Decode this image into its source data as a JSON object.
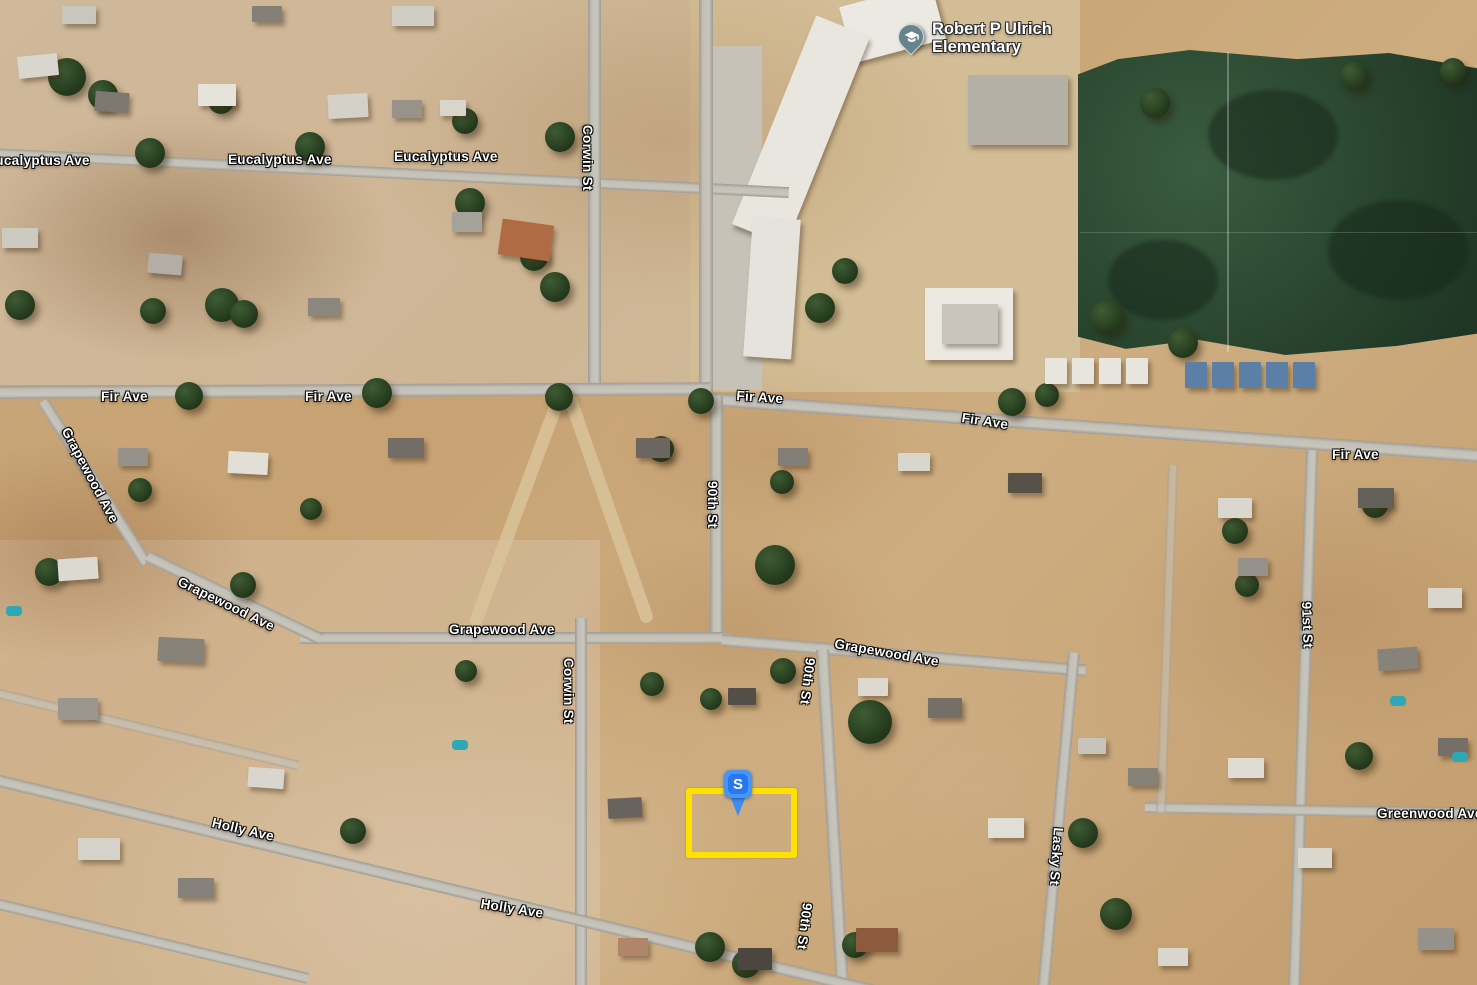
{
  "map": {
    "poi_school": {
      "line1": "Robert P Ulrich",
      "line2": "Elementary"
    },
    "marker": {
      "letter": "S"
    },
    "street_labels": [
      {
        "text": "Eucalyptus Ave"
      },
      {
        "text": "Eucalyptus Ave"
      },
      {
        "text": "Eucalyptus Ave"
      },
      {
        "text": "Corwin St"
      },
      {
        "text": "Fir Ave"
      },
      {
        "text": "Fir Ave"
      },
      {
        "text": "Fir Ave"
      },
      {
        "text": "Fir Ave"
      },
      {
        "text": "Fir Ave"
      },
      {
        "text": "Grapewood Ave"
      },
      {
        "text": "Grapewood Ave"
      },
      {
        "text": "Grapewood Ave"
      },
      {
        "text": "Grapewood Ave"
      },
      {
        "text": "90th St"
      },
      {
        "text": "90th St"
      },
      {
        "text": "90th St"
      },
      {
        "text": "Corwin St"
      },
      {
        "text": "Holly Ave"
      },
      {
        "text": "Holly Ave"
      },
      {
        "text": "Lasky St"
      },
      {
        "text": "91st St"
      },
      {
        "text": "Greenwood Ave"
      }
    ],
    "colors": {
      "parcel_highlight": "#ffe100",
      "marker_blue": "#2877ef",
      "school_pin": "#68838c",
      "label_text": "#ffffff"
    }
  }
}
